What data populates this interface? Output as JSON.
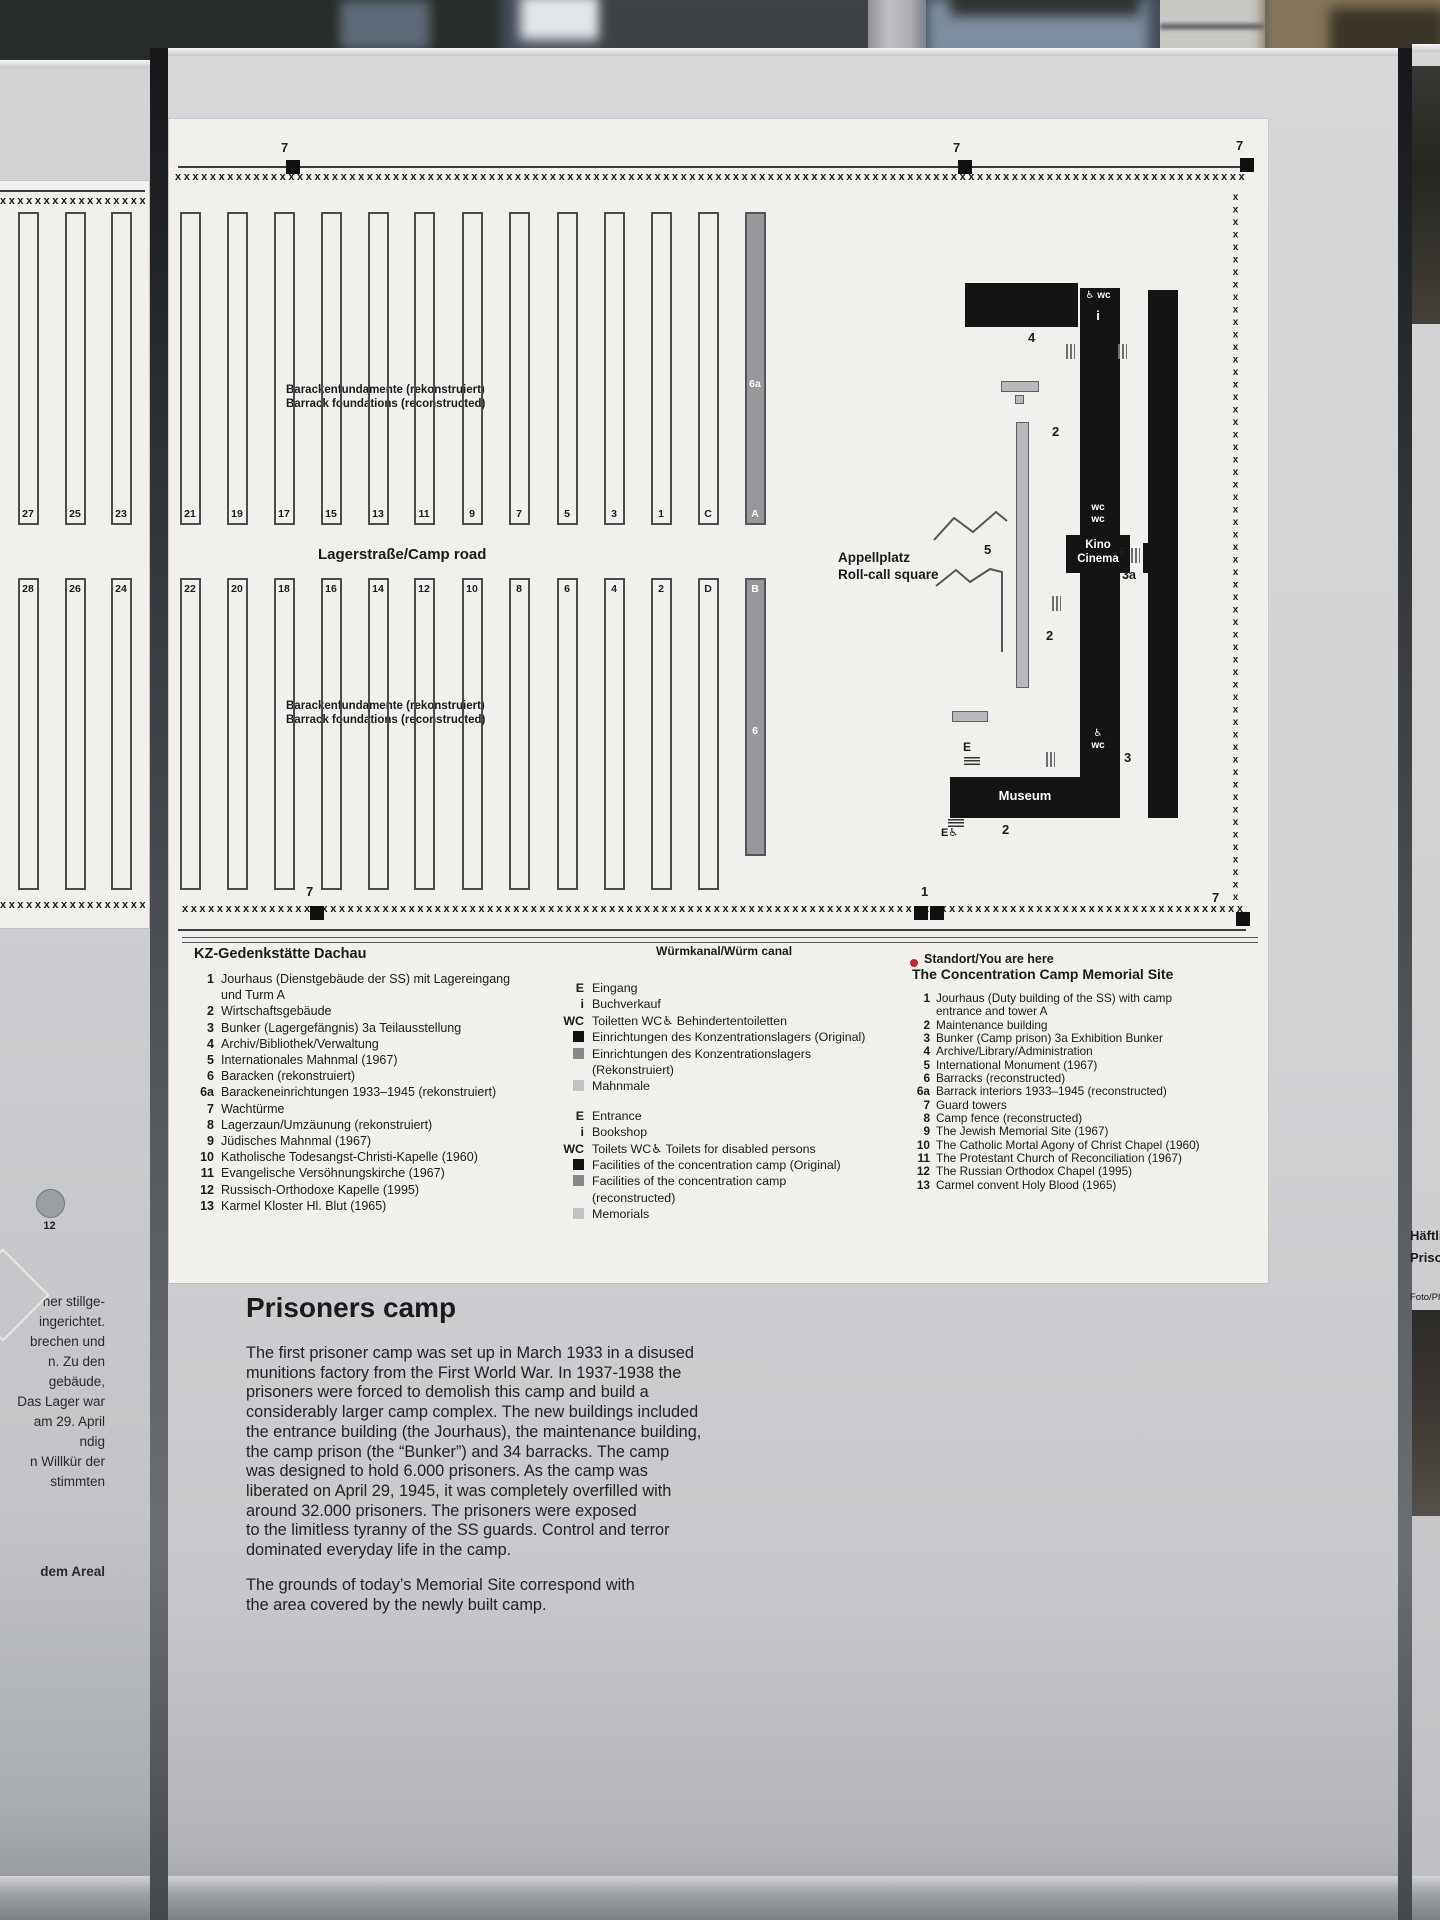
{
  "colors": {
    "accent_red": "#c1272d",
    "building_black": "#141414",
    "reconstructed_gray": "#97979c",
    "memorial_gray": "#c2c2c6",
    "panel_gray": "#d2d3d5",
    "map_white": "#f1f0ec"
  },
  "map": {
    "fence_x": "xxxxxxxxxxxxxxxxxxxxxxxxxxxxxxxxxxxxxxxxxxxxxxxxxxxxxxxxxxxxxxxxxxxxxxxxxxxxxxxxxxxxxxxxxxxxxxxxxxxxxxxxxxxxxxxxxxxxxxxxxxxxxxxxxxxxxxxxxxxxxxxxxxxxxxxxxxxx",
    "labels": {
      "foundations": "Barackenfundamente (rekonstruiert)\nBarrack foundations (reconstructed)",
      "camp_road": "Lagerstraße/Camp road",
      "appellplatz": "Appellplatz\nRoll-call square",
      "canal": "Würmkanal/Würm canal",
      "you_are_here": "Standort/You are here",
      "kino": "Kino\nCinema",
      "museum": "Museum",
      "wc_top": "♿ wc",
      "info": "i",
      "wc_mid": "wc\nwc",
      "wc_low": "♿\nwc"
    },
    "barracks": {
      "row1": [
        {
          "x": 28,
          "n": "27"
        },
        {
          "x": 75,
          "n": "25"
        },
        {
          "x": 121,
          "n": "23"
        },
        {
          "x": 190,
          "n": "21"
        },
        {
          "x": 237,
          "n": "19"
        },
        {
          "x": 284,
          "n": "17"
        },
        {
          "x": 331,
          "n": "15"
        },
        {
          "x": 378,
          "n": "13"
        },
        {
          "x": 424,
          "n": "11"
        },
        {
          "x": 472,
          "n": "9"
        },
        {
          "x": 519,
          "n": "7"
        },
        {
          "x": 567,
          "n": "5"
        },
        {
          "x": 614,
          "n": "3"
        },
        {
          "x": 661,
          "n": "1"
        },
        {
          "x": 708,
          "n": "C"
        },
        {
          "x": 755,
          "n": "A",
          "gray": true,
          "mid": "6a"
        }
      ],
      "row2": [
        {
          "x": 28,
          "n": "28"
        },
        {
          "x": 75,
          "n": "26"
        },
        {
          "x": 121,
          "n": "24"
        },
        {
          "x": 190,
          "n": "22"
        },
        {
          "x": 237,
          "n": "20"
        },
        {
          "x": 284,
          "n": "18"
        },
        {
          "x": 331,
          "n": "16"
        },
        {
          "x": 378,
          "n": "14"
        },
        {
          "x": 424,
          "n": "12"
        },
        {
          "x": 472,
          "n": "10"
        },
        {
          "x": 519,
          "n": "8"
        },
        {
          "x": 567,
          "n": "6"
        },
        {
          "x": 614,
          "n": "4"
        },
        {
          "x": 661,
          "n": "2"
        },
        {
          "x": 708,
          "n": "D"
        },
        {
          "x": 755,
          "n": "B",
          "gray": true,
          "mid": "6",
          "h": 278
        }
      ]
    },
    "towers": [
      {
        "x": 286,
        "y": 160,
        "label": "7",
        "lx": 281,
        "ly": 140
      },
      {
        "x": 958,
        "y": 160,
        "label": "7",
        "lx": 953,
        "ly": 140
      },
      {
        "x": 1240,
        "y": 158,
        "label": "7",
        "lx": 1236,
        "ly": 138
      },
      {
        "x": 310,
        "y": 906,
        "label": "7",
        "lx": 306,
        "ly": 884
      },
      {
        "x": 914,
        "y": 906,
        "label": "1",
        "double": true,
        "lx": 921,
        "ly": 884
      },
      {
        "x": 1236,
        "y": 912,
        "label": "7",
        "lx": 1212,
        "ly": 890
      }
    ],
    "annotations": [
      {
        "t": "4",
        "x": 1028,
        "y": 330,
        "fs": 13
      },
      {
        "t": "2",
        "x": 1052,
        "y": 424,
        "fs": 13
      },
      {
        "t": "2",
        "x": 1046,
        "y": 628,
        "fs": 13
      },
      {
        "t": "2",
        "x": 1002,
        "y": 822,
        "fs": 13
      },
      {
        "t": "5",
        "x": 984,
        "y": 542,
        "fs": 13
      },
      {
        "t": "3a",
        "x": 1122,
        "y": 568,
        "fs": 12.5
      },
      {
        "t": "3",
        "x": 1124,
        "y": 750,
        "fs": 13
      },
      {
        "t": "E",
        "x": 963,
        "y": 740,
        "fs": 12
      },
      {
        "t": "E",
        "x": 1119,
        "y": 545,
        "fs": 12
      },
      {
        "t": "E♿",
        "x": 941,
        "y": 826,
        "fs": 11
      }
    ]
  },
  "legend": {
    "de": {
      "title": "KZ-Gedenkstätte Dachau",
      "items": [
        {
          "num": "1",
          "text": "Jourhaus (Dienstgebäude der SS) mit Lagereingang\nund Turm A"
        },
        {
          "num": "2",
          "text": "Wirtschaftsgebäude"
        },
        {
          "num": "3",
          "text": "Bunker (Lagergefängnis)  3a Teilausstellung"
        },
        {
          "num": "4",
          "text": "Archiv/Bibliothek/Verwaltung"
        },
        {
          "num": "5",
          "text": "Internationales Mahnmal (1967)"
        },
        {
          "num": "6",
          "text": "Baracken (rekonstruiert)"
        },
        {
          "num": "6a",
          "text": "Barackeneinrichtungen 1933–1945 (rekonstruiert)"
        },
        {
          "num": "7",
          "text": "Wachtürme"
        },
        {
          "num": "8",
          "text": "Lagerzaun/Umzäunung (rekonstruiert)"
        },
        {
          "num": "9",
          "text": "Jüdisches Mahnmal (1967)"
        },
        {
          "num": "10",
          "text": "Katholische Todesangst-Christi-Kapelle (1960)"
        },
        {
          "num": "11",
          "text": "Evangelische Versöhnungskirche (1967)"
        },
        {
          "num": "12",
          "text": "Russisch-Orthodoxe Kapelle (1995)"
        },
        {
          "num": "13",
          "text": "Karmel Kloster Hl. Blut (1965)"
        }
      ]
    },
    "en": {
      "title": "The Concentration Camp Memorial Site",
      "items": [
        {
          "num": "1",
          "text": "Jourhaus (Duty building of the SS) with camp\nentrance and tower A"
        },
        {
          "num": "2",
          "text": "Maintenance building"
        },
        {
          "num": "3",
          "text": "Bunker (Camp prison)  3a Exhibition Bunker"
        },
        {
          "num": "4",
          "text": "Archive/Library/Administration"
        },
        {
          "num": "5",
          "text": "International Monument (1967)"
        },
        {
          "num": "6",
          "text": "Barracks (reconstructed)"
        },
        {
          "num": "6a",
          "text": "Barrack interiors 1933–1945 (reconstructed)"
        },
        {
          "num": "7",
          "text": "Guard towers"
        },
        {
          "num": "8",
          "text": "Camp fence (reconstructed)"
        },
        {
          "num": "9",
          "text": "The Jewish Memorial Site (1967)"
        },
        {
          "num": "10",
          "text": "The Catholic Mortal Agony of Christ Chapel (1960)"
        },
        {
          "num": "11",
          "text": "The Protestant Church of Reconciliation (1967)"
        },
        {
          "num": "12",
          "text": "The Russian Orthodox Chapel (1995)"
        },
        {
          "num": "13",
          "text": "Carmel convent Holy Blood (1965)"
        }
      ]
    },
    "symbols": {
      "de": [
        {
          "sym": "E",
          "text": "Eingang"
        },
        {
          "sym": "i",
          "text": "Buchverkauf"
        },
        {
          "sym": "WC",
          "text": "Toiletten   WC♿   Behindertentoiletten"
        },
        {
          "sym": "sq-black",
          "text": "Einrichtungen des Konzentrationslagers (Original)"
        },
        {
          "sym": "sq-dark",
          "text": "Einrichtungen des Konzentrationslagers\n(Rekonstruiert)"
        },
        {
          "sym": "sq-light",
          "text": "Mahnmale"
        }
      ],
      "en": [
        {
          "sym": "E",
          "text": "Entrance"
        },
        {
          "sym": "i",
          "text": "Bookshop"
        },
        {
          "sym": "WC",
          "text": "Toilets   WC♿   Toilets for disabled persons"
        },
        {
          "sym": "sq-black",
          "text": "Facilities of the concentration camp (Original)"
        },
        {
          "sym": "sq-dark",
          "text": "Facilities of the concentration camp\n(reconstructed)"
        },
        {
          "sym": "sq-light",
          "text": "Memorials"
        }
      ]
    }
  },
  "article": {
    "title": "Prisoners camp",
    "para1": "The first prisoner camp was set up in March 1933 in a disused\nmunitions factory from the First World War. In 1937-1938 the\nprisoners were forced to demolish this camp and build a\nconsiderably larger camp complex. The new buildings included\nthe entrance building (the Jourhaus), the maintenance building,\nthe camp prison (the “Bunker”) and 34 barracks. The camp\nwas designed to hold 6.000 prisoners. As the camp was\nliberated on April 29, 1945, it was completely overfilled with\naround 32.000 prisoners. The prisoners were exposed\nto the limitless tyranny of the SS guards. Control and terror\ndominated everyday life in the camp.",
    "para2": "The grounds of today’s Memorial Site correspond with\nthe area covered by the newly built camp."
  },
  "left_panel": {
    "fragment": "ner stillge-\ningerichtet.\nbrechen und\nn. Zu den\ngebäude,\nDas Lager war\nam 29. April\nndig\nn Willkür der\nstimmten",
    "fragment2": "dem Areal",
    "circle_label": "12"
  },
  "right_panel": {
    "line1": "Häftlin",
    "line2": "Prison",
    "credit": "Foto/Pho"
  }
}
